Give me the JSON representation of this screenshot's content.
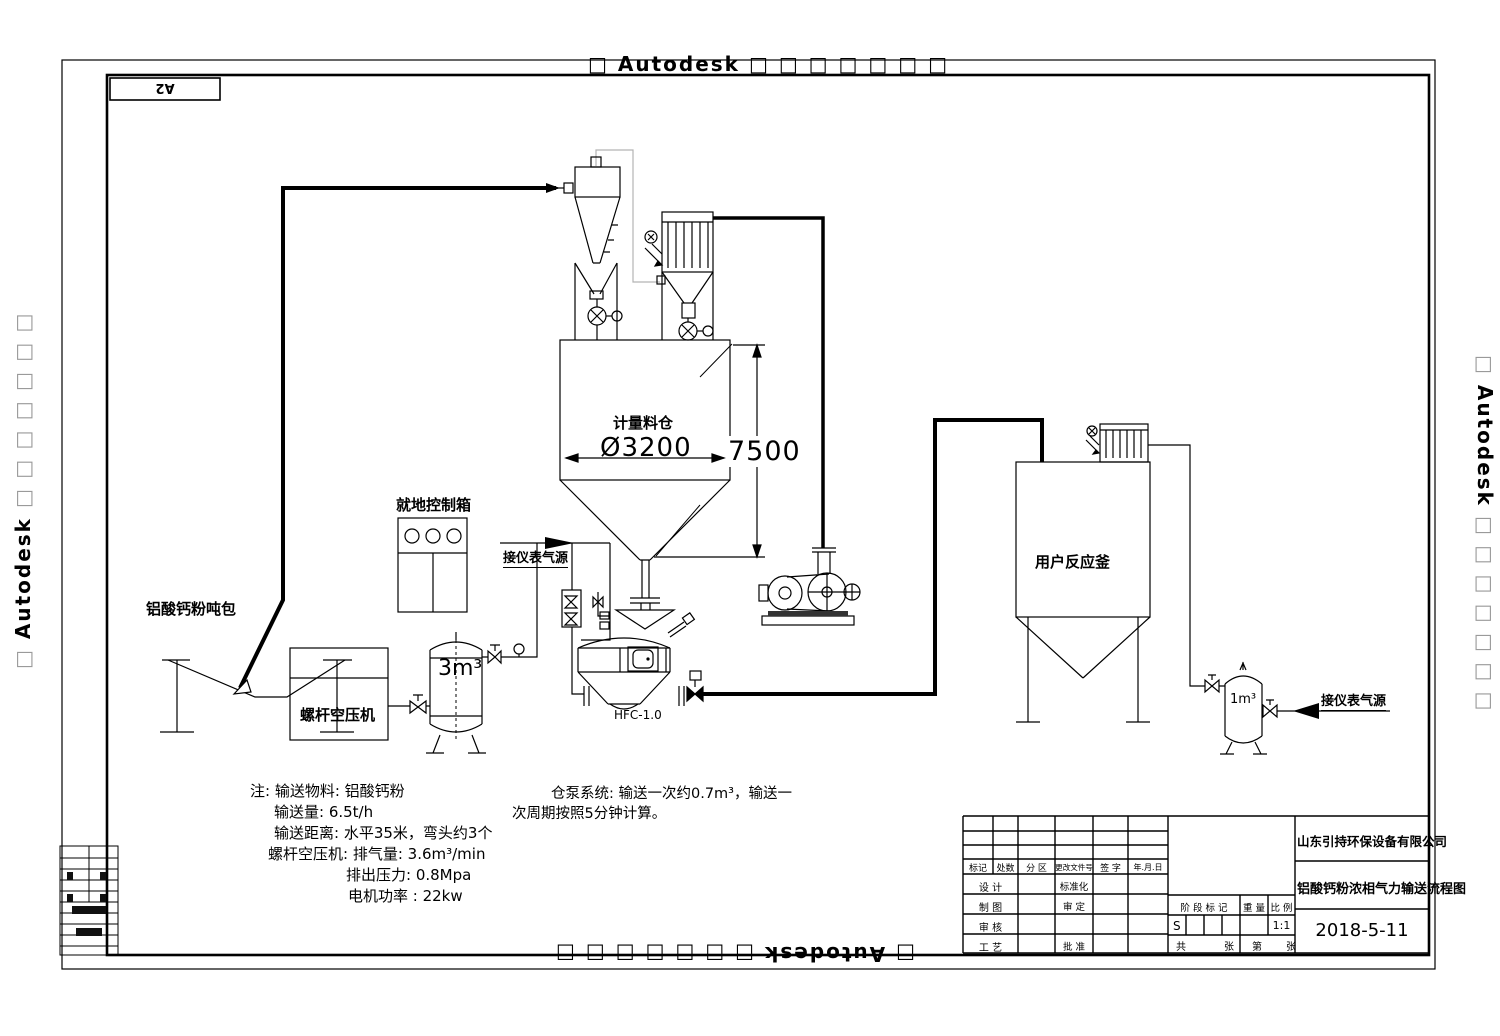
{
  "watermark": {
    "lead": "□",
    "brand": "Autodesk",
    "trail": "□ □ □ □ □ □ □"
  },
  "sheet": {
    "size_label": "A2"
  },
  "equipment": {
    "ton_bag": "铝酸钙粉吨包",
    "control_box": "就地控制箱",
    "compressor": "螺杆空压机",
    "air_tank_3m3": "3m³",
    "silo": "计量料仓",
    "pump": "HFC-1.0",
    "reactor": "用户反应釜",
    "air_tank_1m3": "1m³",
    "instrument_air_left": "接仪表气源",
    "instrument_air_right": "接仪表气源"
  },
  "dimensions": {
    "diameter": "Ø3200",
    "height": "7500"
  },
  "notes": [
    "注: 输送物料: 铝酸钙粉",
    "输送量: 6.5t/h",
    "输送距离: 水平35米，弯头约3个",
    "螺杆空压机: 排气量: 3.6m³/min",
    "排出压力: 0.8Mpa",
    "电机功率 : 22kw"
  ],
  "pump_note": [
    "仓泵系统: 输送一次约0.7m³，输送一",
    "次周期按照5分钟计算。"
  ],
  "titleblock": {
    "company": "山东引持环保设备有限公司",
    "drawing_title": "铝酸钙粉浓相气力输送流程图",
    "date": "2018-5-11",
    "header_cols": [
      "标记",
      "处数",
      "分 区",
      "更改文件号",
      "签 字",
      "年.月.日"
    ],
    "left_rows": [
      "设 计",
      "制 图",
      "审 核",
      "工 艺"
    ],
    "mid_rows": [
      "标准化",
      "审 定",
      "批 准"
    ],
    "stage_label": "阶 段 标 记",
    "weight_label": "重 量",
    "scale_label": "比 例",
    "stage_value": "S",
    "scale_value": "1:1",
    "total_label": "共",
    "sheet_word": "张",
    "page_label": "第",
    "page_word": "张"
  }
}
